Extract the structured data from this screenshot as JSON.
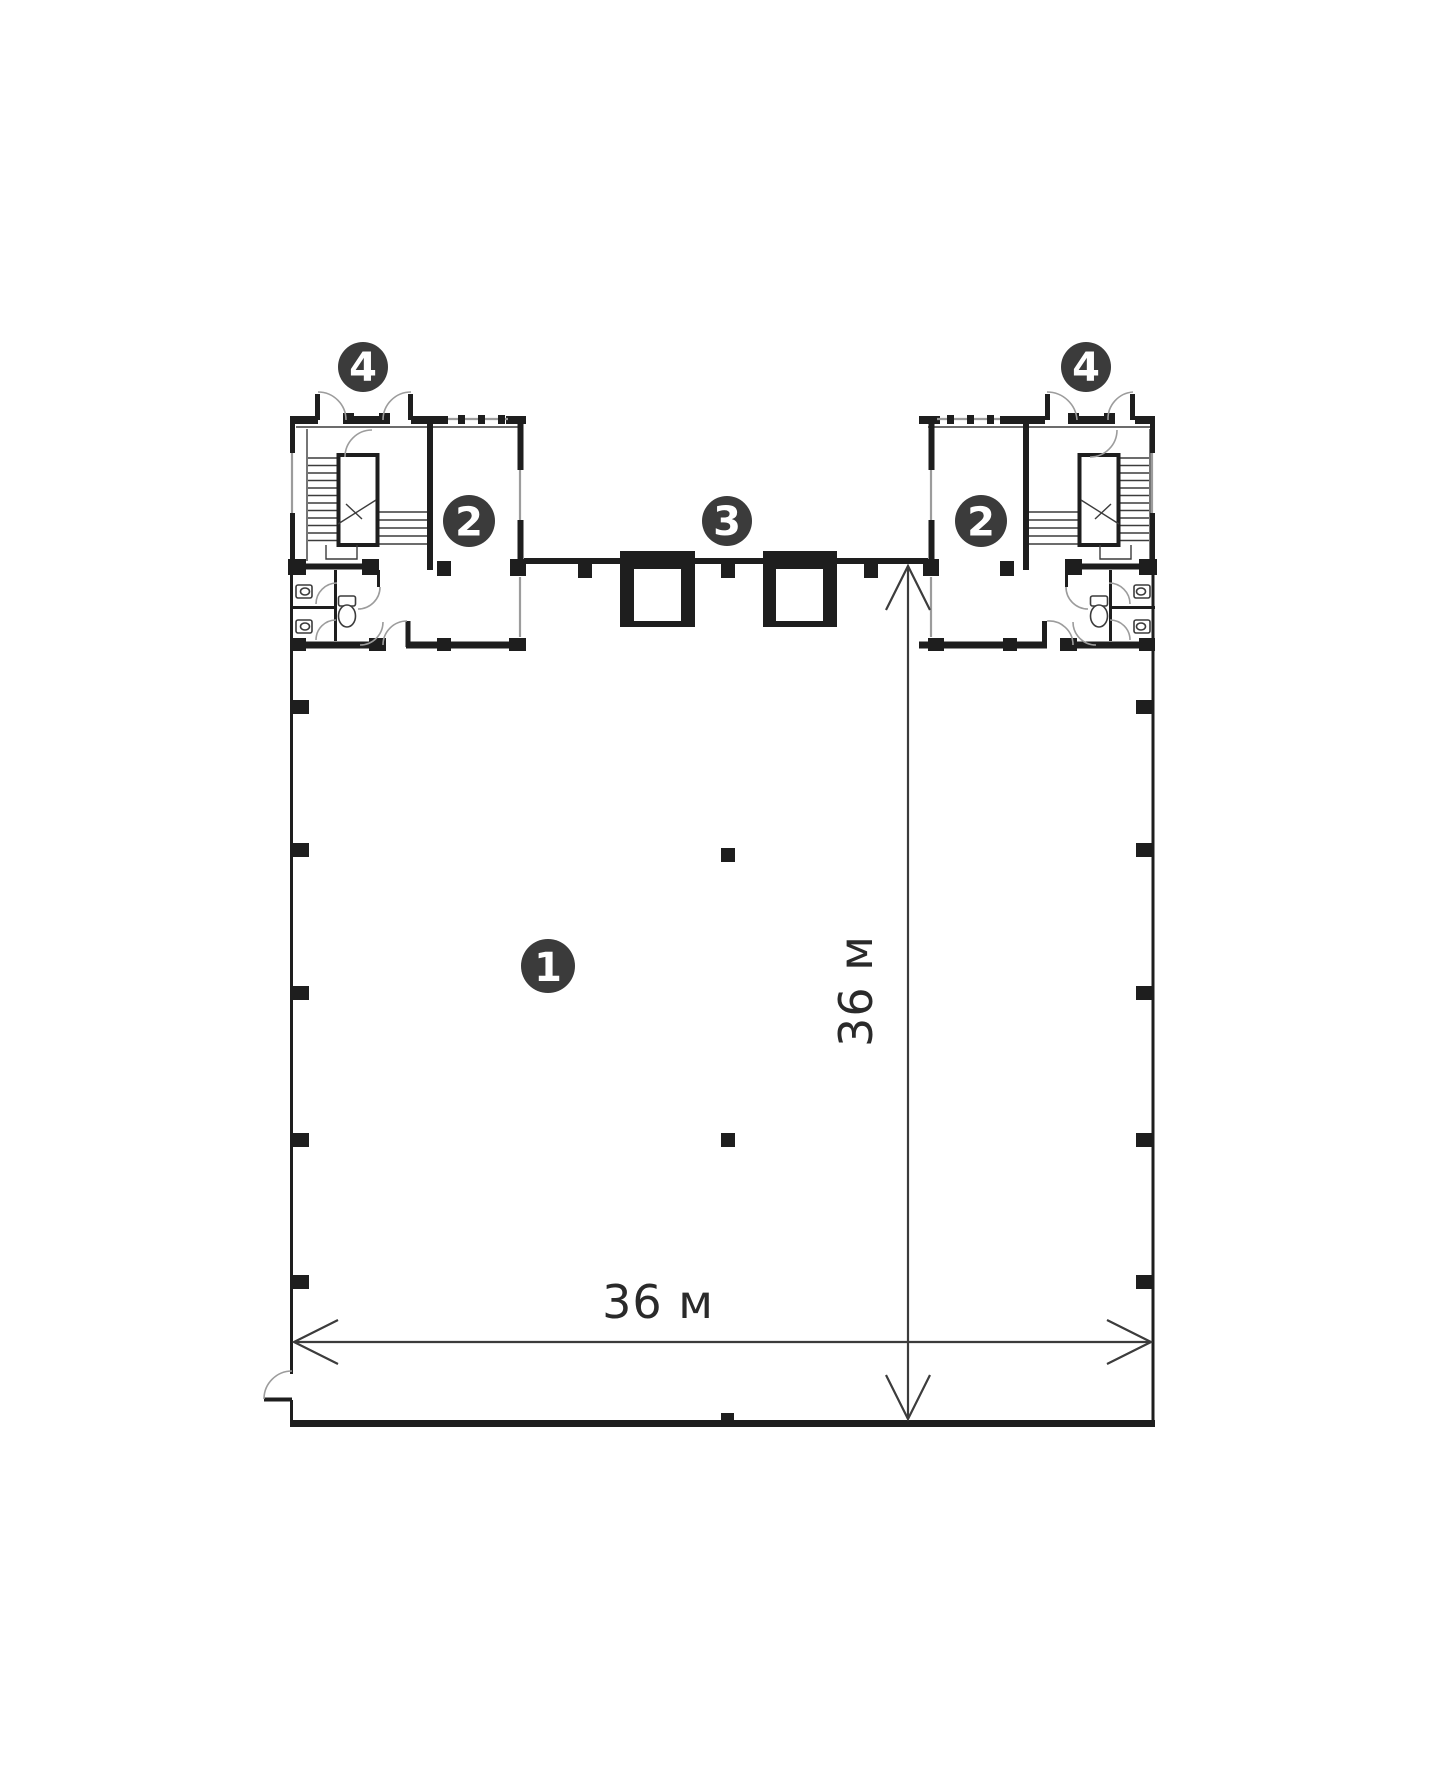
{
  "page": {
    "background": "#ffffff"
  },
  "colors": {
    "wall": "#1e1e1e",
    "line": "#3c3c3c",
    "arc": "#9c9c9c",
    "dim": "#3c3c3c",
    "badge_fill": "#3b3b3b",
    "badge_text": "#ffffff"
  },
  "badges": [
    {
      "name": "room-badge-hall",
      "label": "1",
      "x": 548,
      "y": 966,
      "r": 27
    },
    {
      "name": "room-badge-left-office",
      "label": "2",
      "x": 469,
      "y": 521,
      "r": 26
    },
    {
      "name": "room-badge-right-office",
      "label": "2",
      "x": 981,
      "y": 521,
      "r": 26
    },
    {
      "name": "room-badge-elevators",
      "label": "3",
      "x": 727,
      "y": 521,
      "r": 25
    },
    {
      "name": "room-badge-left-stair",
      "label": "4",
      "x": 363,
      "y": 367,
      "r": 25
    },
    {
      "name": "room-badge-right-stair",
      "label": "4",
      "x": 1086,
      "y": 367,
      "r": 25
    }
  ],
  "dimensions": [
    {
      "name": "dim-width",
      "label": "36 м",
      "orientation": "horizontal",
      "x1": 294,
      "y1": 1342,
      "x2": 1151,
      "y2": 1342,
      "label_x": 658,
      "label_y": 1318
    },
    {
      "name": "dim-height",
      "label": "36 м",
      "orientation": "vertical",
      "x1": 908,
      "y1": 566,
      "x2": 908,
      "y2": 1419,
      "label_x": 872,
      "label_y": 991
    }
  ]
}
